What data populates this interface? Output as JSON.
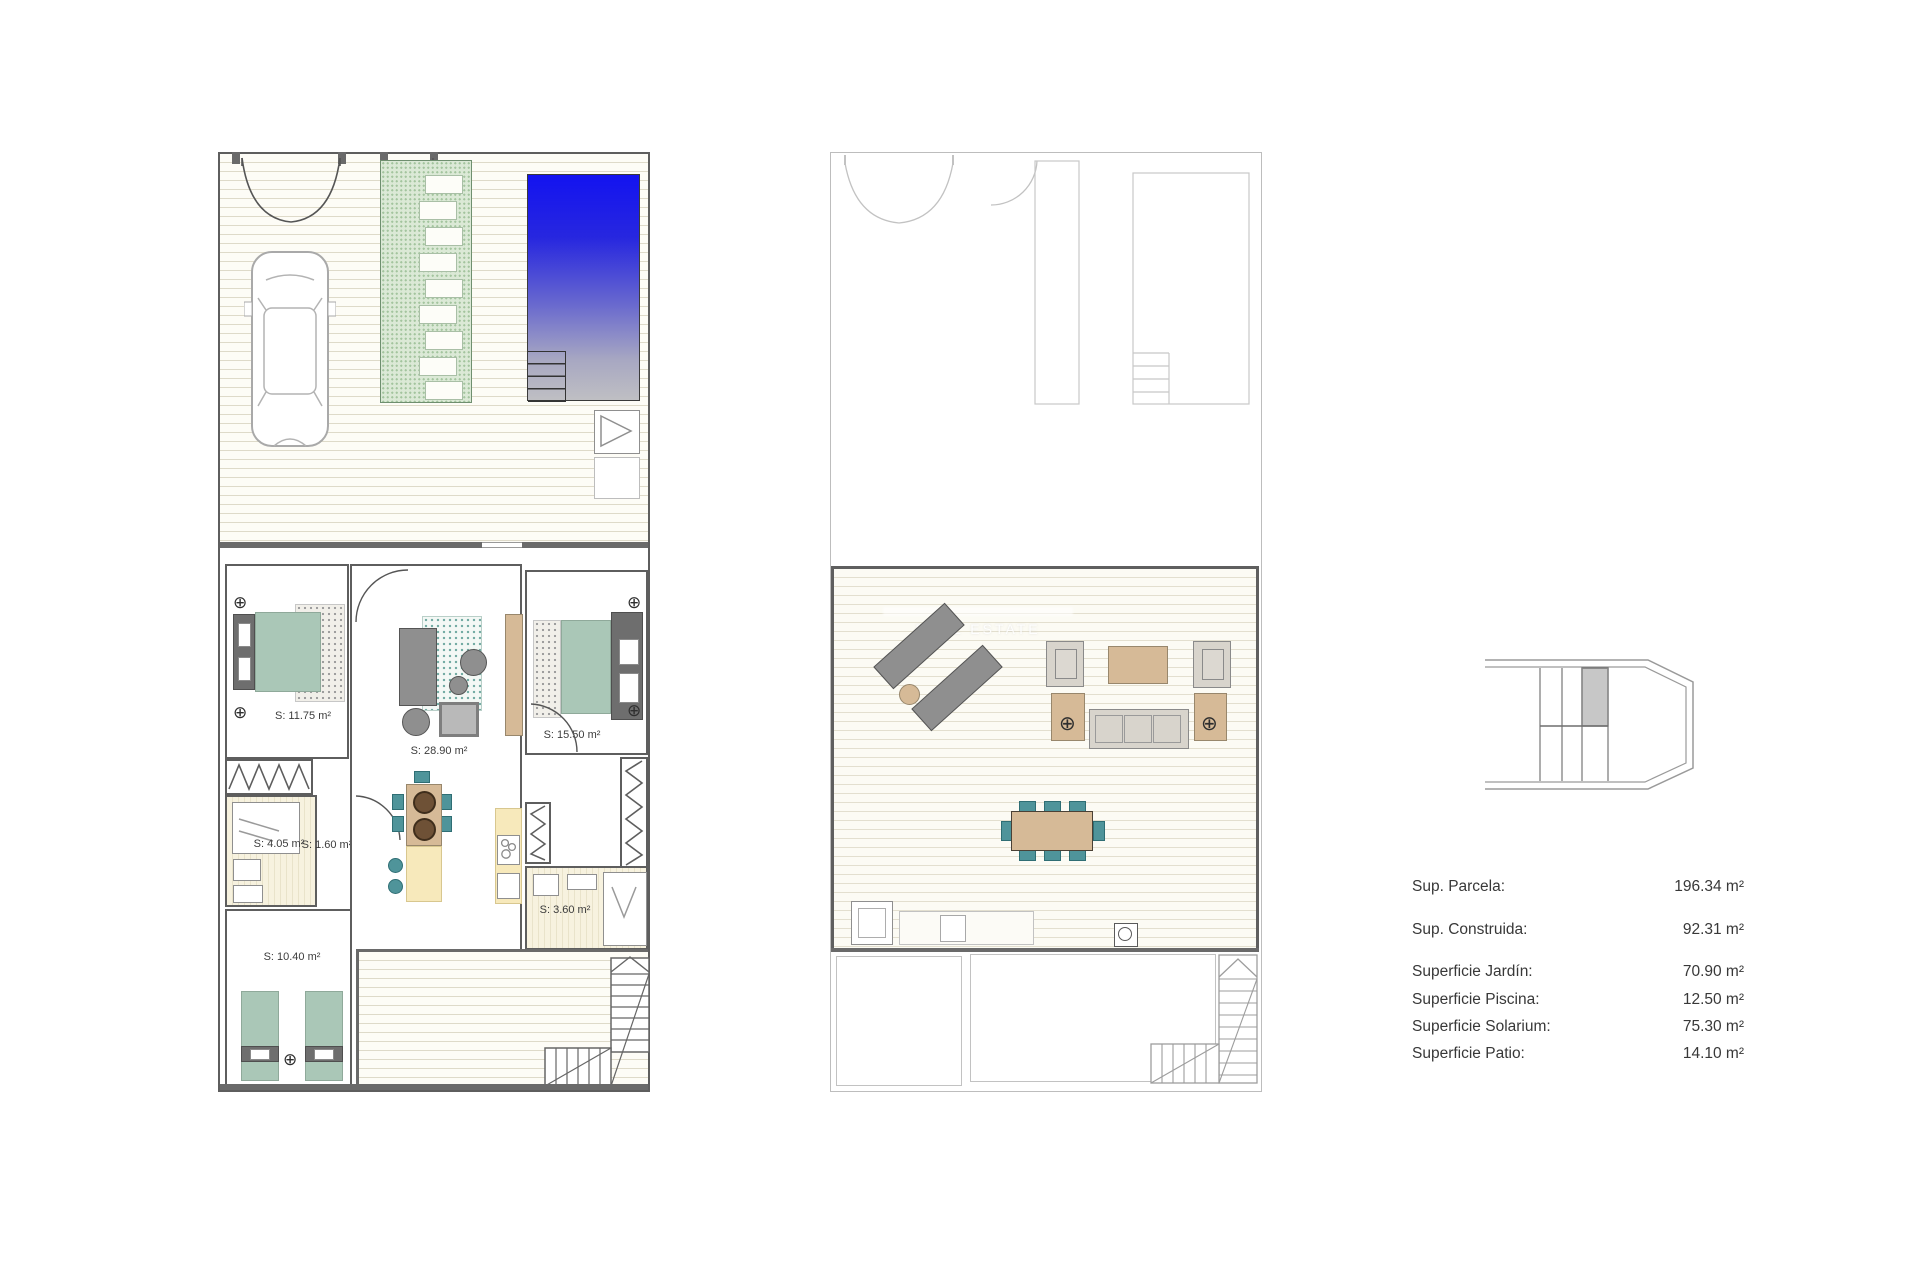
{
  "rooms": {
    "bedroom_1175": "S: 11.75 m²",
    "living": "S: 28.90 m²",
    "bedroom_1550": "S: 15.50 m²",
    "bath_405": "S: 4.05 m²",
    "hall_160": "S: 1.60 m²",
    "bath_360": "S: 3.60 m²",
    "bedroom_1040": "S: 10.40 m²"
  },
  "watermark": {
    "text": "REAL ESTATE"
  },
  "icons": {
    "ceiling_light": "⊕"
  },
  "summary": {
    "rows": [
      {
        "label": "Sup. Parcela:",
        "value": "196.34 m²"
      },
      {
        "label": "Sup. Construida:",
        "value": "92.31 m²"
      },
      {
        "label": "Superficie Jardín:",
        "value": "70.90 m²"
      },
      {
        "label": "Superficie Piscina:",
        "value": "12.50 m²"
      },
      {
        "label": "Superficie Solarium:",
        "value": "75.30 m²"
      },
      {
        "label": "Superficie Patio:",
        "value": "14.10 m²"
      }
    ]
  },
  "colors": {
    "pool_blue": "#1313f0",
    "path_green": "#dbe9d6",
    "bed_green": "#aac7b7",
    "furniture_tan": "#d6ba97",
    "chair_teal": "#4f949a",
    "counter_yellow": "#f7e9bb",
    "highlight_unit_gray": "#c7c7c7"
  }
}
